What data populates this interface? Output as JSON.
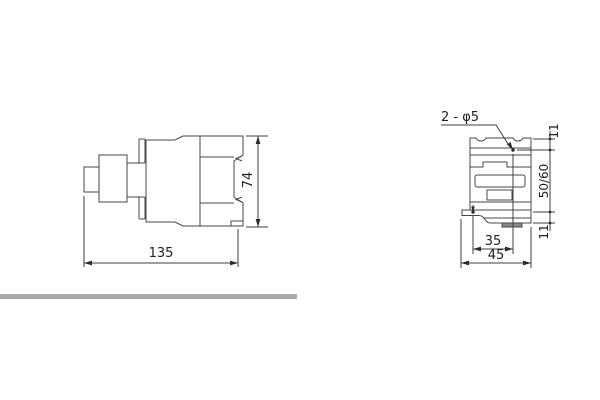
{
  "side_view": {
    "width_dim": "135",
    "height_dim": "74"
  },
  "front_view": {
    "holes_note": "2 - φ5",
    "top_hole_offset_dim": "11",
    "hole_span_dim": "50/60",
    "bottom_hole_offset_dim": "11",
    "hole_spacing_dim": "35",
    "width_dim": "45"
  },
  "colors": {
    "line": "#474747",
    "text": "#1f1f1f",
    "divider_bar": "#a9a9a9",
    "clip_fill": "#8a8a8a",
    "background": "#ffffff"
  }
}
